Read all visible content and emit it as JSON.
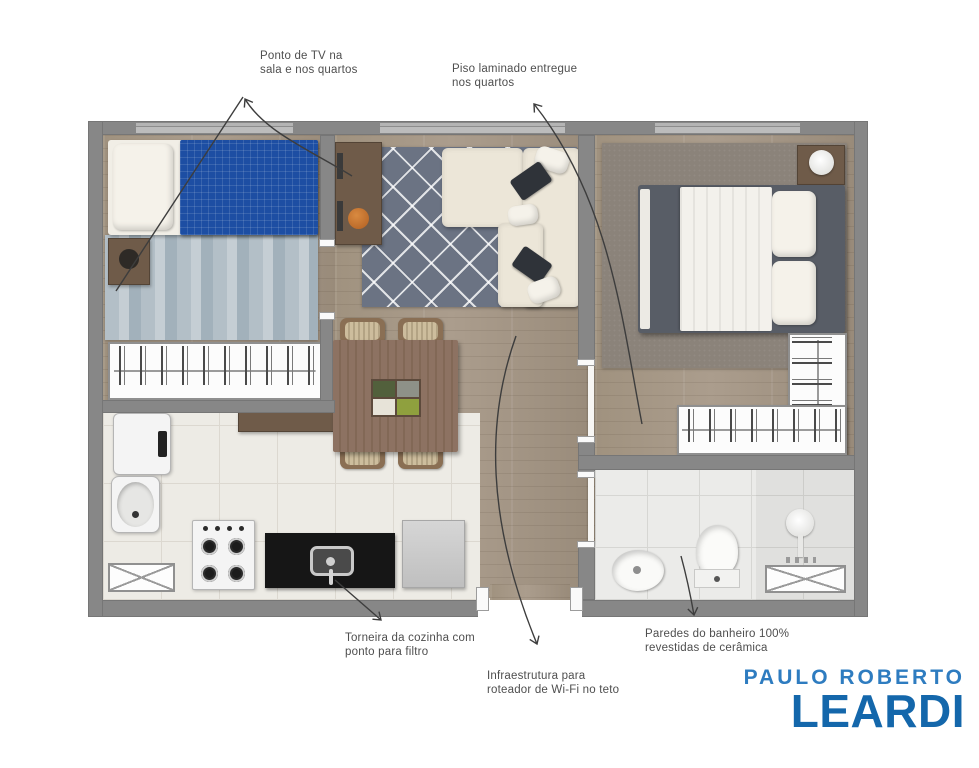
{
  "annotations": {
    "tv": {
      "line1": "Ponto de TV na",
      "line2": "sala e nos quartos"
    },
    "laminate": {
      "line1": "Piso laminado entregue",
      "line2": "nos quartos"
    },
    "faucet": {
      "line1": "Torneira da cozinha com",
      "line2": "ponto para filtro"
    },
    "wifi": {
      "line1": "Infraestrutura para",
      "line2": "roteador de Wi-Fi no teto"
    },
    "bathroom": {
      "line1": "Paredes do banheiro 100%",
      "line2": "revestidas de cerâmica"
    }
  },
  "logo": {
    "line1": "PAULO ROBERTO",
    "line2": "LEARDI"
  },
  "colors": {
    "wall": "#878787",
    "wood_floor": "#a4988a",
    "kitchen_tile": "#edebe5",
    "living_rug": "#6b7383",
    "bedroom1_rug": "#b3bfc7",
    "bedroom2_rug": "#8b837a",
    "bed_blanket_blue": "#1d4ea3",
    "annotation_text": "#4e4e4e",
    "arrow": "#3d3d3d",
    "logo_top_blue": "#2e7cc0",
    "logo_main_blue": "#1467ab"
  },
  "floorplan": {
    "rooms": [
      {
        "name": "bedroom-1",
        "furniture": [
          "single-bed",
          "nightstand",
          "striped-rug",
          "wardrobe"
        ]
      },
      {
        "name": "living-room",
        "furniture": [
          "tv-sideboard",
          "diamond-rug",
          "l-shaped-sofa"
        ]
      },
      {
        "name": "dining-area",
        "furniture": [
          "dining-table",
          "four-chairs",
          "bench"
        ]
      },
      {
        "name": "kitchen",
        "furniture": [
          "washer",
          "laundry-tank",
          "stove",
          "black-counter-sink",
          "fridge",
          "reserved-space"
        ]
      },
      {
        "name": "bedroom-2",
        "furniture": [
          "double-bed",
          "nightstand-lamp",
          "rug",
          "l-shaped-wardrobe"
        ]
      },
      {
        "name": "bathroom",
        "furniture": [
          "sink",
          "toilet",
          "shower",
          "shower-box"
        ]
      },
      {
        "name": "hall-entry",
        "furniture": []
      }
    ]
  }
}
